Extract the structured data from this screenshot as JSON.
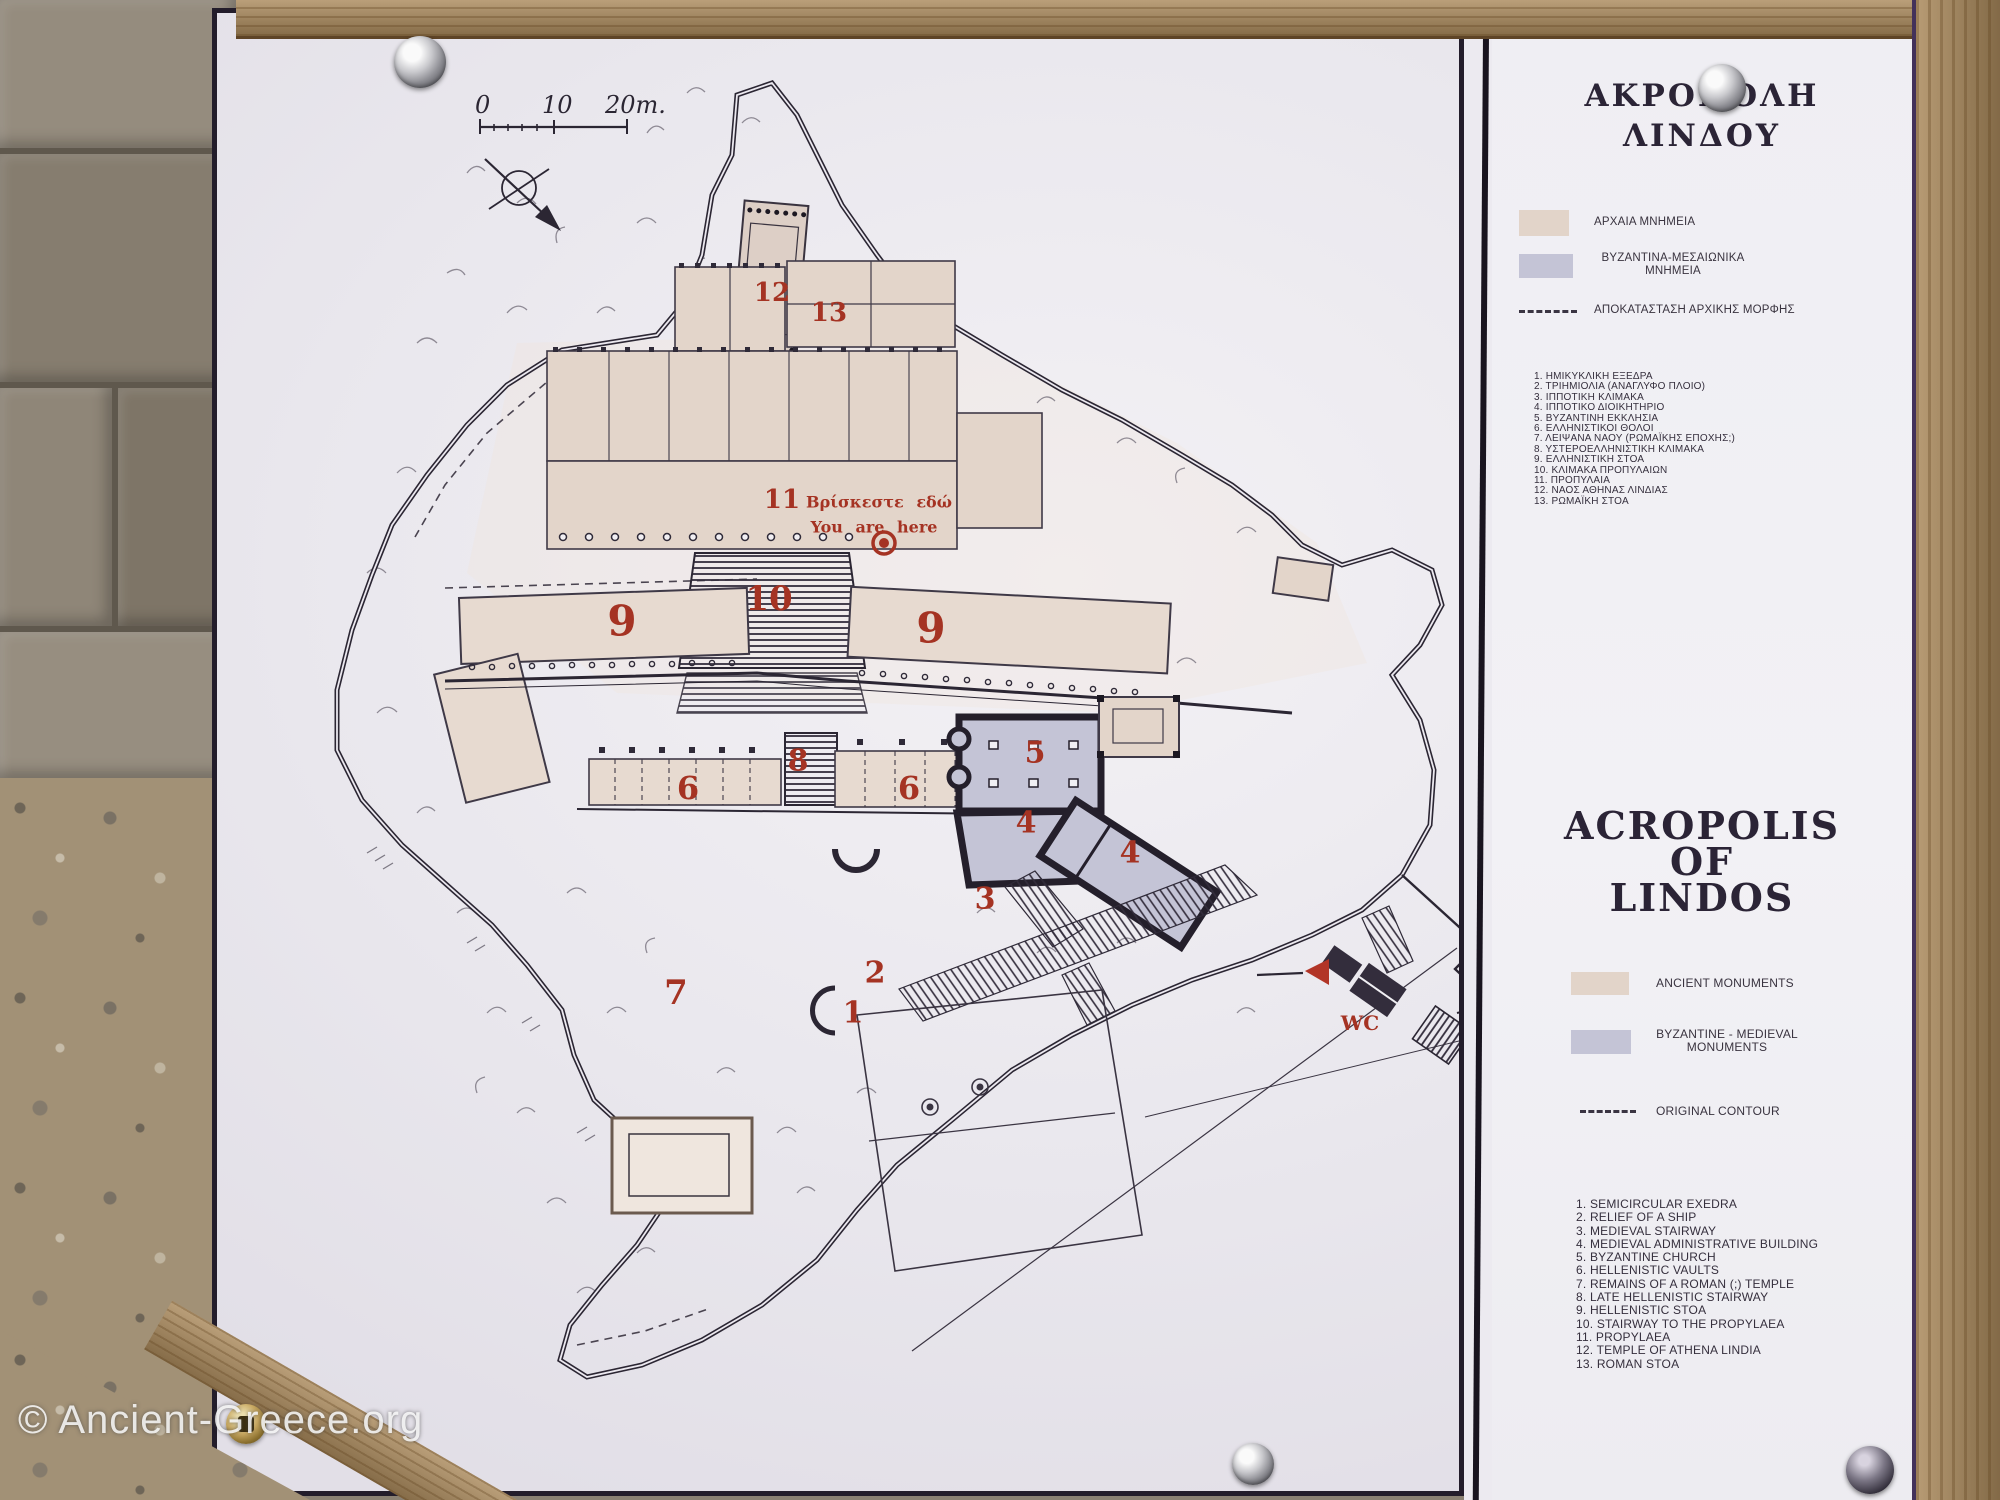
{
  "photo": {
    "watermark": "© Ancient-Greece.org"
  },
  "map": {
    "scale": {
      "zero": "0",
      "ten": "10",
      "twenty": "20m."
    },
    "you_are_here": {
      "greek": "Βρίσκεστε εδώ",
      "english": "You are here"
    },
    "labels": [
      {
        "text": "12",
        "x": 555,
        "y": 280,
        "s": 26
      },
      {
        "text": "13",
        "x": 612,
        "y": 300,
        "s": 26
      },
      {
        "text": "11",
        "x": 565,
        "y": 487,
        "s": 26
      },
      {
        "text": "10",
        "x": 552,
        "y": 586,
        "s": 34
      },
      {
        "text": "9",
        "x": 405,
        "y": 608,
        "s": 42
      },
      {
        "text": "9",
        "x": 714,
        "y": 615,
        "s": 42
      },
      {
        "text": "8",
        "x": 581,
        "y": 748,
        "s": 30
      },
      {
        "text": "6",
        "x": 471,
        "y": 775,
        "s": 32
      },
      {
        "text": "6",
        "x": 692,
        "y": 775,
        "s": 32
      },
      {
        "text": "5",
        "x": 818,
        "y": 740,
        "s": 30
      },
      {
        "text": "4",
        "x": 809,
        "y": 810,
        "s": 30
      },
      {
        "text": "4",
        "x": 913,
        "y": 840,
        "s": 30
      },
      {
        "text": "3",
        "x": 768,
        "y": 886,
        "s": 30
      },
      {
        "text": "2",
        "x": 658,
        "y": 960,
        "s": 30
      },
      {
        "text": "1",
        "x": 636,
        "y": 1000,
        "s": 30
      },
      {
        "text": "7",
        "x": 459,
        "y": 980,
        "s": 34
      },
      {
        "text": "WC",
        "x": 1143,
        "y": 1010,
        "s": 20
      }
    ]
  },
  "sidebar": {
    "title_greek": [
      "ΑΚΡΟΠΟΛΗ",
      "ΛΙΝΔΟΥ"
    ],
    "legend_greek": [
      "ΑΡΧΑΙΑ ΜΝΗΜΕΙΑ",
      "ΒΥΖΑΝΤΙΝΑ-ΜΕΣΑΙΩΝΙΚΑ ΜΝΗΜΕΙΑ",
      "ΑΠΟΚΑΤΑΣΤΑΣΗ ΑΡΧΙΚΗΣ ΜΟΡΦΗΣ"
    ],
    "list_greek": [
      "1. ΗΜΙΚΥΚΛΙΚΗ ΕΞΕΔΡΑ",
      "2. ΤΡΙΗΜΙΟΛΙΑ (ΑΝΑΓΛΥΦΟ ΠΛΟΙΟ)",
      "3. ΙΠΠΟΤΙΚΗ ΚΛΙΜΑΚΑ",
      "4. ΙΠΠΟΤΙΚΟ ΔΙΟΙΚΗΤΗΡΙΟ",
      "5. ΒΥΖΑΝΤΙΝΗ ΕΚΚΛΗΣΙΑ",
      "6. ΕΛΛΗΝΙΣΤΙΚΟΙ ΘΟΛΟΙ",
      "7. ΛΕΙΨΑΝΑ ΝΑΟΥ (ΡΩΜΑΪΚΗΣ ΕΠΟΧΗΣ;)",
      "8. ΥΣΤΕΡΟΕΛΛΗΝΙΣΤΙΚΗ ΚΛΙΜΑΚΑ",
      "9. ΕΛΛΗΝΙΣΤΙΚΗ ΣΤΟΑ",
      "10. ΚΛΙΜΑΚΑ ΠΡΟΠΥΛΑΙΩΝ",
      "11. ΠΡΟΠΥΛΑΙΑ",
      "12. ΝΑΟΣ ΑΘΗΝΑΣ ΛΙΝΔΙΑΣ",
      "13. ΡΩΜΑΪΚΗ ΣΤΟΑ"
    ],
    "title_english": [
      "ACROPOLIS",
      "OF",
      "LINDOS"
    ],
    "legend_english": [
      "ANCIENT MONUMENTS",
      "BYZANTINE - MEDIEVAL MONUMENTS",
      "ORIGINAL CONTOUR"
    ],
    "list_english": [
      "1. SEMICIRCULAR EXEDRA",
      "2. RELIEF OF A SHIP",
      "3. MEDIEVAL STAIRWAY",
      "4. MEDIEVAL ADMINISTRATIVE BUILDING",
      "5. BYZANTINE CHURCH",
      "6. HELLENISTIC VAULTS",
      "7. REMAINS OF A ROMAN (;) TEMPLE",
      "8. LATE HELLENISTIC STAIRWAY",
      "9. HELLENISTIC STOA",
      "10. STAIRWAY TO THE PROPYLAEA",
      "11. PROPYLAEA",
      "12. TEMPLE OF ATHENA LINDIA",
      "13. ROMAN STOA"
    ]
  },
  "colors": {
    "ancient": "#e2d4c9",
    "byzantine": "#c4c4d6",
    "label_red": "#a53323",
    "panel_black": "#231d2b"
  }
}
